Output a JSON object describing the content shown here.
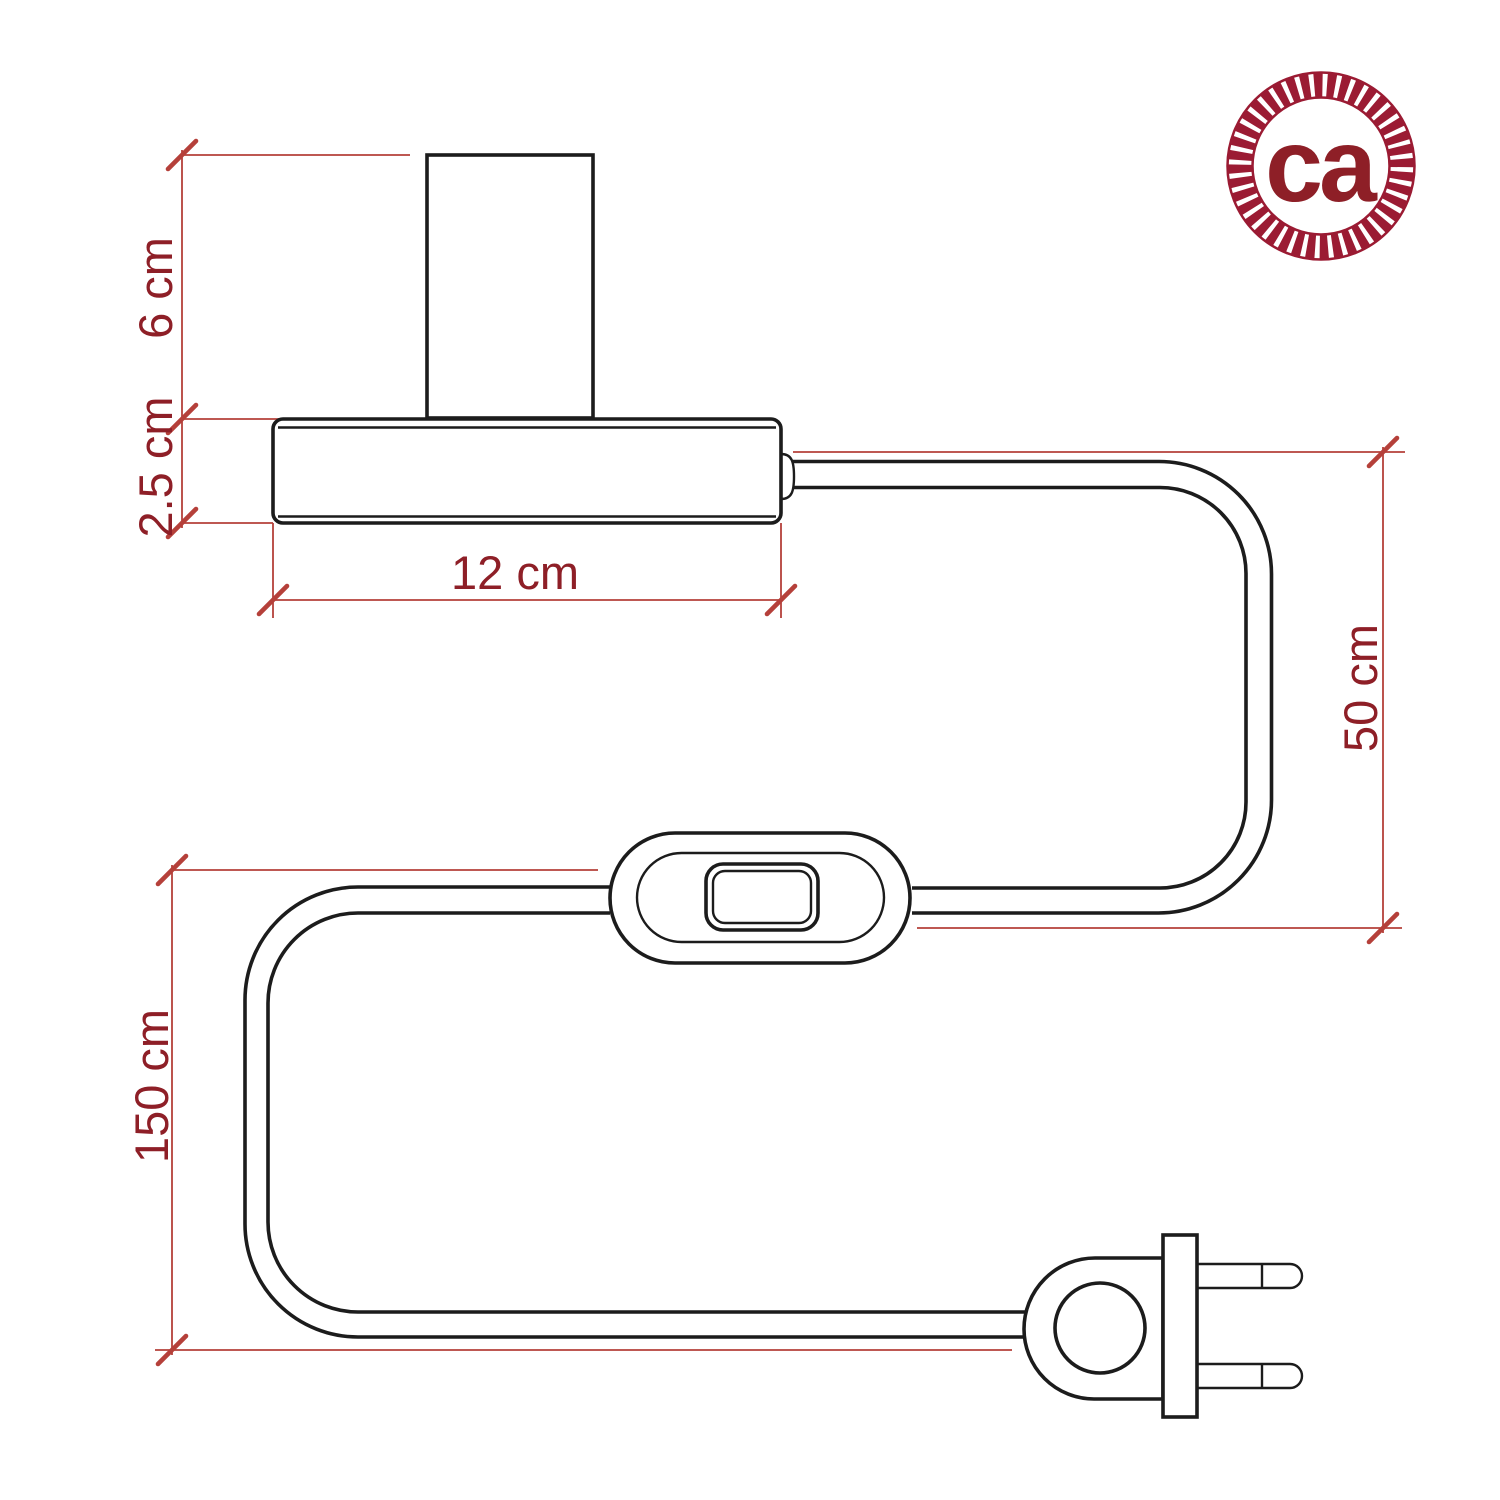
{
  "logo": {
    "text": "ca"
  },
  "dims": {
    "socket_height": {
      "label": "6 cm",
      "value": 6,
      "unit": "cm"
    },
    "base_height": {
      "label": "2.5 cm",
      "value": 2.5,
      "unit": "cm"
    },
    "base_width": {
      "label": "12 cm",
      "value": 12,
      "unit": "cm"
    },
    "cable_socket_to_switch": {
      "label": "50 cm",
      "value": 50,
      "unit": "cm"
    },
    "cable_overall": {
      "label": "150 cm",
      "value": 150,
      "unit": "cm"
    }
  },
  "colors": {
    "background": "#ffffff",
    "dimension_line": "#b5403a",
    "dimension_text": "#8e1f27",
    "drawing_stroke": "#1c1c1c",
    "logo_ring": "#9b1b33",
    "logo_text": "#1a1a1a"
  }
}
